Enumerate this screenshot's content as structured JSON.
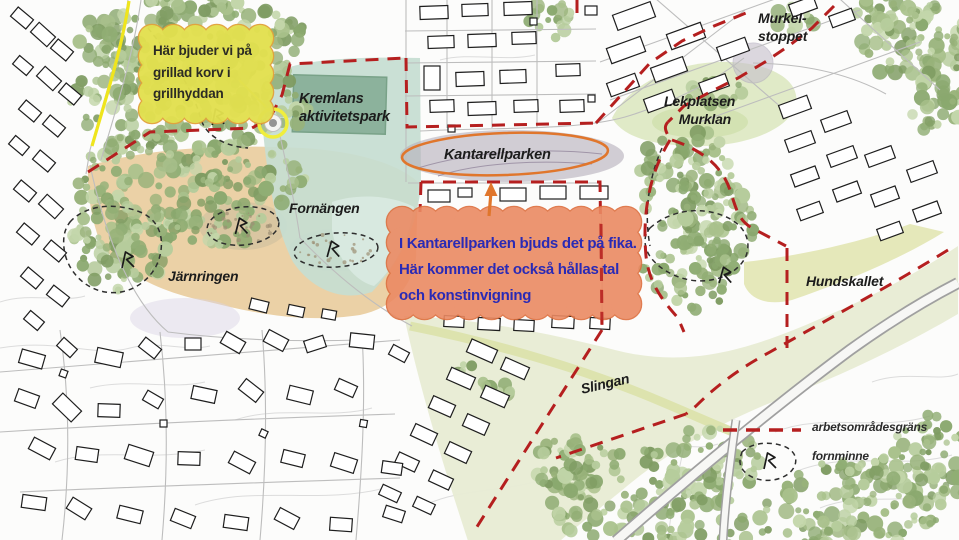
{
  "labels": {
    "kremlans": "Kremlans\naktivitetspark",
    "kantarellparken": "Kantarellparken",
    "fornangen": "Fornängen",
    "jarnringen": "Järnringen",
    "murkelstoppet": "Murkel-\nstoppet",
    "lekplatsen_murklan": "Lekplatsen\n    Murklan",
    "hundskallet": "Hundskallet",
    "slingan": "Slingan"
  },
  "callouts": {
    "grill": "Här bjuder vi på\ngrillad korv i\ngrillhyddan",
    "fika": "I Kantarellparken bjuds det på fika.\nHär kommer det också hållas tal\noch konstinvigning"
  },
  "legend": {
    "items": [
      {
        "symbol": "red-dashed-line",
        "label": "arbetsområdesgräns"
      },
      {
        "symbol": "fornminne-outline",
        "label": "fornminne"
      }
    ]
  },
  "colors": {
    "boundary_red": "#b51f1f",
    "black_dash": "#2e2e2e",
    "callout_grill_fill": "#e2e04f",
    "callout_grill_border": "#e2a23c",
    "callout_grill_text": "#2c2c24",
    "callout_fika_fill": "#eb8a63",
    "callout_fika_border": "#dd6f3e",
    "callout_fika_text": "#2a2ab5",
    "highlight_orange": "#e0762c",
    "highlight_yellow": "#f0ee3c",
    "fornangen_fill": "#ebd1a6",
    "park_teal": "#c5ddd1",
    "sports_field_green": "#8cb29c",
    "kantarell_gray": "#b7b0bb",
    "meadow_green": "#e8ecd4",
    "path_yellow_green": "#dde3ae"
  }
}
